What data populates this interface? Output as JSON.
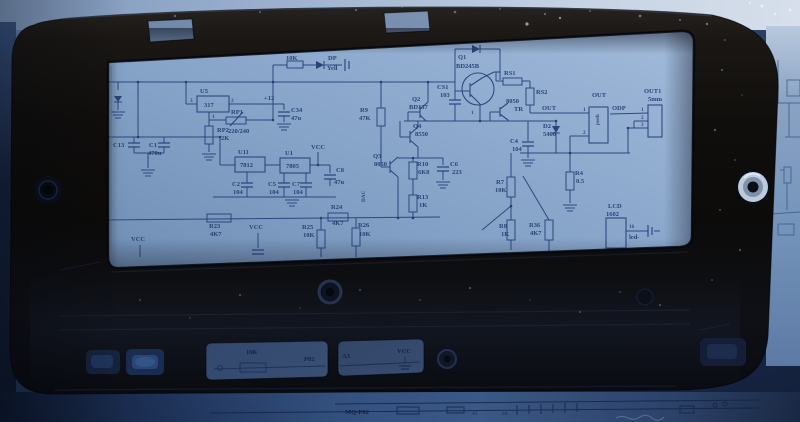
{
  "scene": {
    "subject": "black plastic enclosure frame lying on a blue-tinted printed circuit schematic sheet",
    "colors": {
      "case": "#100e0c",
      "paper": "#8aa6c9",
      "ink": "#1e3a6e"
    }
  },
  "win": [
    "RP",
    "10K",
    "DP",
    "Yell",
    "U5",
    "317",
    "3",
    "2",
    "1",
    "RP1",
    "220/240",
    "RP2",
    "2K",
    "+12",
    "C34",
    "47u",
    "R9",
    "47K",
    "C13",
    "C1",
    "470u",
    "U11",
    "7812",
    "U1",
    "7805",
    "VCC",
    "C2",
    "104",
    "C5",
    "104",
    "C7",
    "104",
    "C8",
    "47u",
    "Q2",
    "BD137",
    "Q4",
    "8550",
    "Q3",
    "8050",
    "R10",
    "6K8",
    "C6",
    "223",
    "R13",
    "1K",
    "Q1",
    "BD245B",
    "CS1",
    "103",
    "1",
    "RS1",
    "RS2",
    "8050",
    "TR",
    "OUT",
    "D2",
    "5400",
    "OUT",
    "push",
    "1",
    "2",
    "ODP",
    "OUT1",
    "5mm",
    "1",
    "2",
    "3",
    "C4",
    "104",
    "R4",
    "0.5",
    "R7",
    "10K",
    "R8",
    "1K",
    "R36",
    "4K7",
    "LCD",
    "1602",
    "16",
    "led-",
    "R23",
    "4K7",
    "VCC",
    "R25",
    "10K",
    "R24",
    "4K7",
    "R26",
    "10K",
    "VCC",
    "DAC"
  ],
  "slots": [
    "10K",
    "P02",
    "A3",
    "VCC"
  ],
  "strip": [
    "MQ-P02",
    "43",
    "04"
  ]
}
